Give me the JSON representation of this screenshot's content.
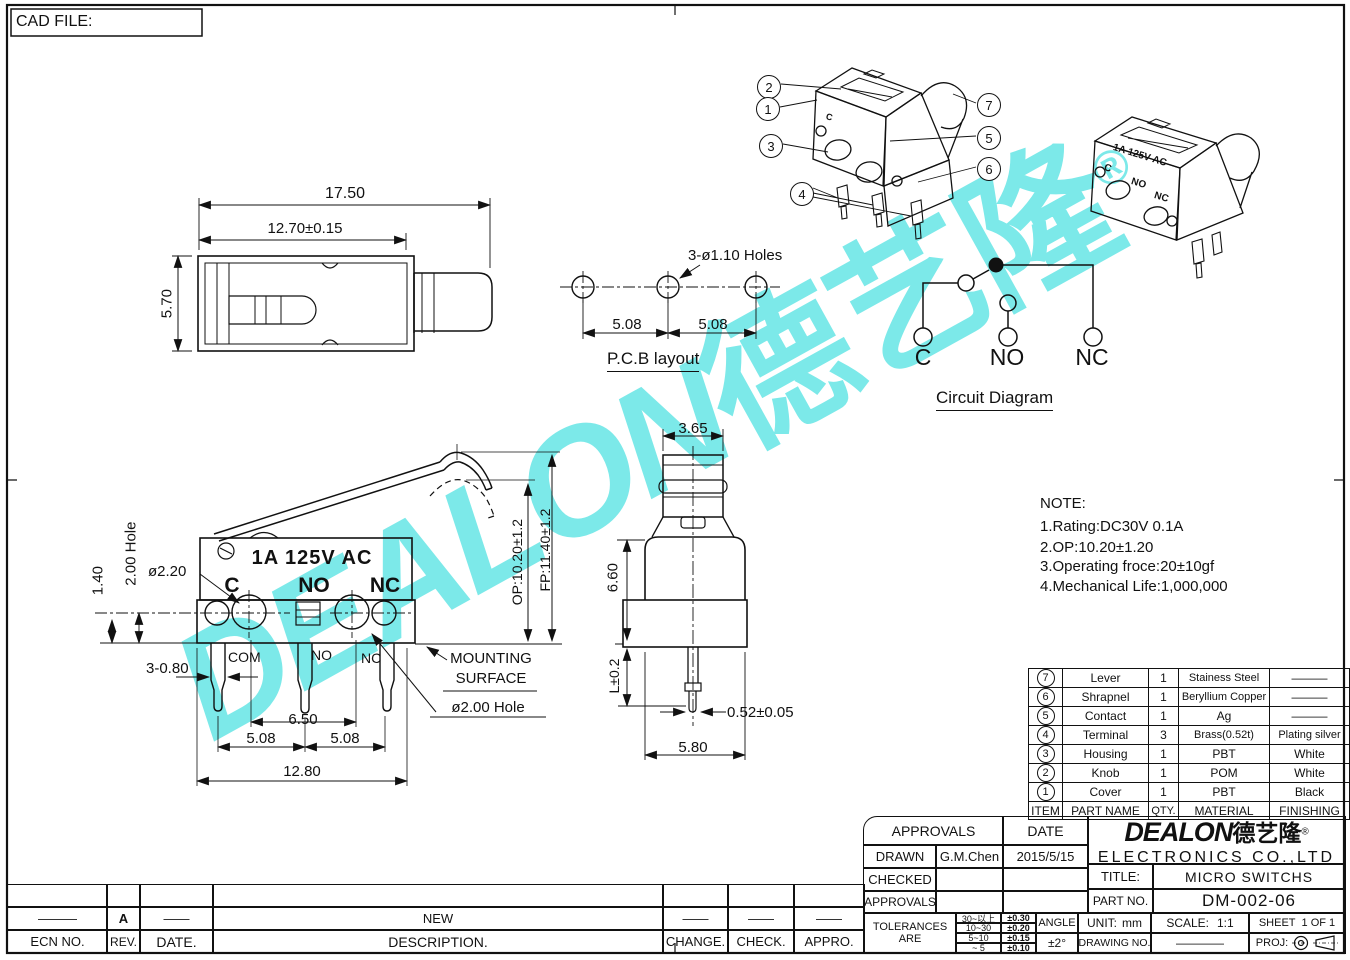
{
  "cad_file_label": "CAD FILE:",
  "watermark": {
    "latin": "DEALON",
    "cjk": "德艺隆",
    "reg": "®"
  },
  "top_view": {
    "dim_total": "17.50",
    "dim_body": "12.70±0.15",
    "dim_height": "5.70"
  },
  "pcb_layout": {
    "holes_label": "3-ø1.10  Holes",
    "pitch_left": "5.08",
    "pitch_right": "5.08",
    "caption": "P.C.B  layout"
  },
  "circuit": {
    "c": "C",
    "no": "NO",
    "nc": "NC",
    "caption": "Circuit  Diagram"
  },
  "callouts": {
    "c1": "1",
    "c2": "2",
    "c3": "3",
    "c4": "4",
    "c5": "5",
    "c6": "6",
    "c7": "7"
  },
  "persp": {
    "marking_c": "C",
    "rating": "1A 125V AC",
    "c": "C",
    "no": "NO",
    "nc": "NC"
  },
  "front_view": {
    "rating": "1A 125V AC",
    "c": "C",
    "no": "NO",
    "nc": "NC",
    "com": "COM",
    "no_pin": "NO",
    "nc_pin": "NC",
    "dim_hole2": "2.00  Hole",
    "dim_140": "1.40",
    "dim_220": "ø2.20",
    "dim_legs": "3-0.80",
    "dim_650": "6.50",
    "dim_508l": "5.08",
    "dim_508r": "5.08",
    "dim_1280": "12.80",
    "mounting_line1": "MOUNTING",
    "mounting_line2": "SURFACE",
    "dim_hole200": "ø2.00  Hole",
    "op": "OP:10.20±1.2",
    "fp": "FP:11.40±1.2"
  },
  "side_view": {
    "dim_365": "3.65",
    "dim_660": "6.60",
    "dim_len": "L±0.2",
    "dim_052": "0.52±0.05",
    "dim_580": "5.80"
  },
  "note": {
    "title": "NOTE:",
    "line1": "1.Rating:DC30V  0.1A",
    "line2": "2.OP:10.20±1.20",
    "line3": "3.Operating  froce:20±10gf",
    "line4": "4.Mechanical  Life:1,000,000"
  },
  "parts_table": {
    "headers": {
      "item": "ITEM",
      "name": "PART  NAME",
      "qty": "QTY.",
      "material": "MATERIAL",
      "finishing": "FINISHING"
    },
    "rows": [
      {
        "item": "7",
        "name": "Lever",
        "qty": "1",
        "material": "Stainess  Steel",
        "finishing": "———"
      },
      {
        "item": "6",
        "name": "Shrapnel",
        "qty": "1",
        "material": "Beryllium  Copper",
        "finishing": "———"
      },
      {
        "item": "5",
        "name": "Contact",
        "qty": "1",
        "material": "Ag",
        "finishing": "———"
      },
      {
        "item": "4",
        "name": "Terminal",
        "qty": "3",
        "material": "Brass(0.52t)",
        "finishing": "Plating  silver"
      },
      {
        "item": "3",
        "name": "Housing",
        "qty": "1",
        "material": "PBT",
        "finishing": "White"
      },
      {
        "item": "2",
        "name": "Knob",
        "qty": "1",
        "material": "POM",
        "finishing": "White"
      },
      {
        "item": "1",
        "name": "Cover",
        "qty": "1",
        "material": "PBT",
        "finishing": "Black"
      }
    ]
  },
  "title_block": {
    "approvals_header": "APPROVALS",
    "date_header": "DATE",
    "drawn_label": "DRAWN",
    "drawn_name": "G.M.Chen",
    "drawn_date": "2015/5/15",
    "checked_label": "CHECKED",
    "approvals_label": "APPROVALS",
    "company": {
      "logo_latin": "DEALON",
      "logo_cjk": "德艺隆",
      "logo_reg": "®",
      "name": "ELECTRONICS  CO.,LTD"
    },
    "title_label": "TITLE:",
    "title_value": "MICRO  SWITCHS",
    "part_label": "PART  NO.",
    "part_value": "DM-002-06",
    "tolerances": {
      "label": "TOLERANCES  ARE",
      "rows": [
        {
          "range": "30~以上",
          "value": "±0.30"
        },
        {
          "range": "10~30",
          "value": "±0.20"
        },
        {
          "range": "5~10",
          "value": "±0.15"
        },
        {
          "range": "~ 5",
          "value": "±0.10"
        }
      ],
      "angle_label": "ANGLE",
      "angle_value": "±2°"
    },
    "unit_label": "UNIT:",
    "unit_value": "mm",
    "scale_label": "SCALE:",
    "scale_value": "1:1",
    "sheet_label": "SHEET",
    "sheet_value": "1  OF  1",
    "drawing_label": "DRAWING  NO.",
    "drawing_value": "————",
    "proj_label": "PROJ:"
  },
  "revision": {
    "ecn_value": "———",
    "rev_value": "A",
    "date_value": "——",
    "desc_value": "NEW",
    "change_value": "——",
    "check_value": "——",
    "appro_value": "——",
    "headers": {
      "ecn": "ECN  NO.",
      "rev": "REV.",
      "date": "DATE.",
      "desc": "DESCRIPTION.",
      "change": "CHANGE.",
      "check": "CHECK.",
      "appro": "APPRO."
    }
  }
}
